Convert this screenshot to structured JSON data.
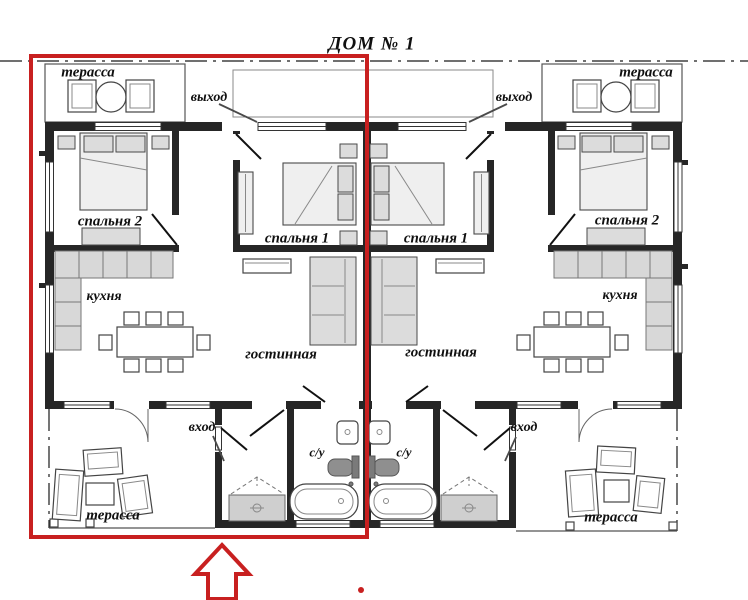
{
  "title": "ДОМ № 1",
  "colors": {
    "wall": "#262626",
    "annotation_red": "#c82020",
    "furniture_fill": "#dcdcdc",
    "counter_fill": "#d8d8d8"
  },
  "labels": {
    "terrace_top_left": "терасса",
    "terrace_top_right": "терасса",
    "terrace_bottom_left": "терасса",
    "terrace_bottom_right": "терасса",
    "exit_left": "выход",
    "exit_right": "выход",
    "entrance_left": "вход",
    "entrance_right": "вход",
    "bedroom2_left": "спальня 2",
    "bedroom2_right": "спальня 2",
    "bedroom1_left": "спальня 1",
    "bedroom1_right": "спальня 1",
    "kitchen_left": "кухня",
    "kitchen_right": "кухня",
    "living_left": "гостинная",
    "living_right": "гостинная",
    "bathroom_left": "с/у",
    "bathroom_right": "с/у"
  }
}
